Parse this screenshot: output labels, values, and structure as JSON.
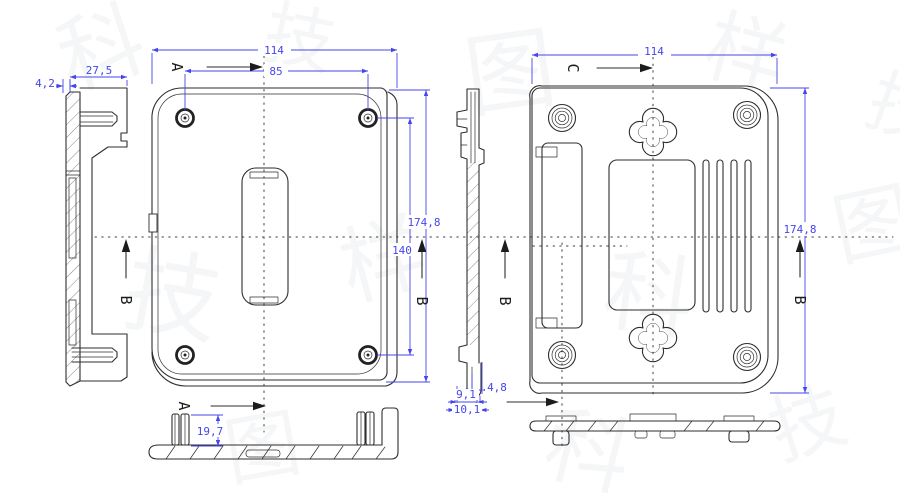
{
  "sections": {
    "a": "A",
    "b": "B",
    "c": "C"
  },
  "dims": {
    "left": {
      "step": "4,2",
      "depth": "27,5"
    },
    "front": {
      "width": "114",
      "hole_span": "85",
      "height": "174,8",
      "hole_span_v": "140"
    },
    "bottom": {
      "post_height": "19,7"
    },
    "profile": {
      "hook_width": "4,8",
      "depth_inner": "9,1",
      "depth_outer": "10,1"
    },
    "back": {
      "width": "114",
      "height": "174,8"
    }
  },
  "colors": {
    "dimension": "#4646ec",
    "linework": "#2e2e2e",
    "centerline": "#3f3f3f",
    "background": "#ffffff",
    "watermark": "#5a6370"
  },
  "watermark": {
    "g1": "科",
    "g2": "技",
    "g3": "图",
    "g4": "样"
  }
}
